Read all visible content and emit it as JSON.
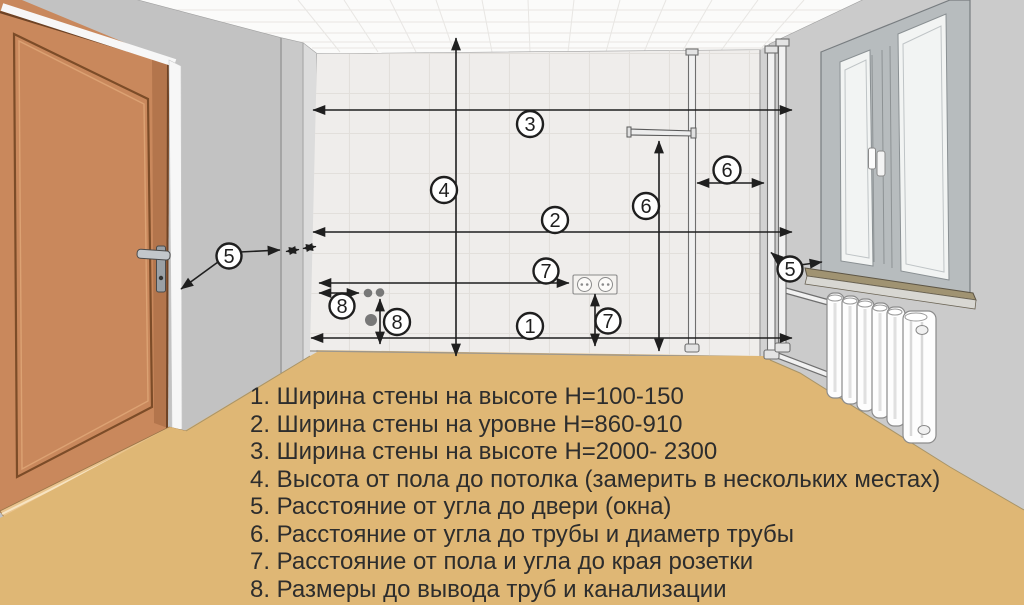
{
  "title": "Схема замеров комнаты",
  "legend": {
    "items": [
      "1. Ширина стены на высоте Н=100-150",
      "2. Ширина стены на уровне Н=860-910",
      "3. Ширина стены на высоте Н=2000- 2300",
      "4. Высота от пола до потолка (замерить в нескольких местах)",
      "5. Расстояние от угла до двери (окна)",
      "6. Расстояние от угла до трубы и диаметр трубы",
      "7. Расстояние от пола и угла до края розетки",
      "8. Размеры до вывода труб и канализации"
    ]
  },
  "markers": [
    "1",
    "2",
    "3",
    "4",
    "5",
    "5",
    "6",
    "6",
    "7",
    "7",
    "8",
    "8"
  ],
  "fixtures": {
    "door": "дверь",
    "window": "окно",
    "radiator": "радиатор",
    "pipes": "трубы",
    "socket": "розетка"
  },
  "colors": {
    "floor": "#dfb775",
    "ceiling": "#fbfbfa",
    "wall_main": "#efedeb",
    "wall_left": "#c2c2c2",
    "wall_right": "#cbcbcb",
    "door": "#c9885c",
    "door_trim": "#7c4c28",
    "threshold": "#eac48e",
    "sill": "#a09372",
    "line": "#1f1f1f",
    "legend_text": "#2d2d2d",
    "marker_fill": "#ffffff"
  }
}
